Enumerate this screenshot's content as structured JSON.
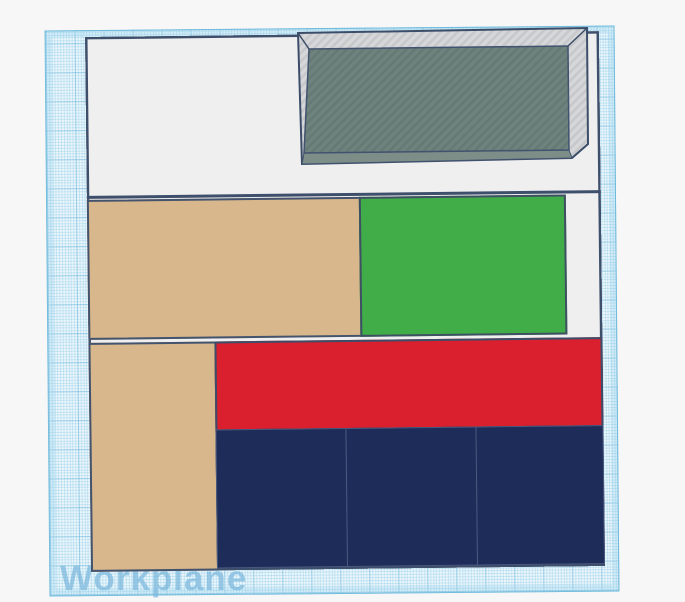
{
  "workplane": {
    "label": "Workplane",
    "grid": {
      "base_color": "#edf7fc",
      "fine_line_color": "#bfe2f2",
      "major_line_color": "#8ecbe5",
      "edge_color": "#7fc5e2",
      "label_color": "#76b4da"
    }
  },
  "scene": {
    "base_plate": {
      "fill": "#efeff0",
      "outline": "#3d4f6b"
    },
    "objects": [
      {
        "id": "gray-tray",
        "kind": "hollow-box",
        "location": "top-right",
        "rim_light": "#d6d7d9",
        "rim_dark": "#c7c8cc",
        "floor": "#6e827e",
        "floor_stripe": "#667a75",
        "wall": "#7d8e89",
        "outline": "#3c4d69"
      },
      {
        "id": "tan-wide-block",
        "kind": "block",
        "location": "middle-left",
        "fill": "#d7b78b"
      },
      {
        "id": "green-block",
        "kind": "block",
        "location": "middle-right",
        "fill": "#41ad49"
      },
      {
        "id": "tan-tall-block",
        "kind": "block",
        "location": "bottom-left",
        "fill": "#d7b78b"
      },
      {
        "id": "red-wide-block",
        "kind": "block",
        "location": "center",
        "fill": "#da202e"
      },
      {
        "id": "navy-block-left",
        "kind": "block",
        "location": "bottom-left-of-row",
        "fill": "#1e2c5a"
      },
      {
        "id": "navy-block-middle",
        "kind": "block",
        "location": "bottom-middle-of-row",
        "fill": "#1e2c5a"
      },
      {
        "id": "navy-block-right",
        "kind": "block",
        "location": "bottom-right-of-row",
        "fill": "#1e2c5a"
      }
    ]
  }
}
